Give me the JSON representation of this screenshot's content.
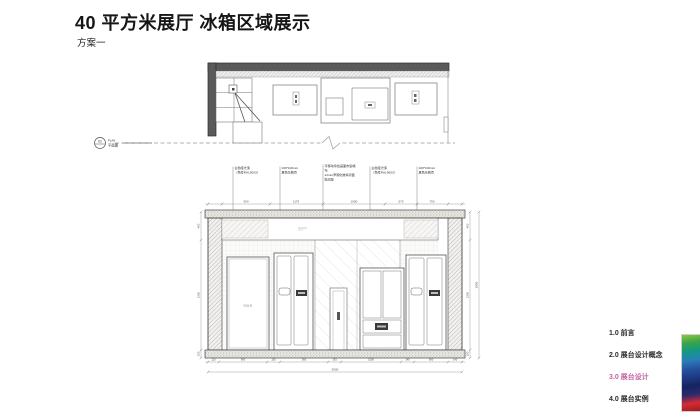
{
  "page": {
    "title": "40 平方米展厅 冰箱区域展示",
    "subtitle": "方案一"
  },
  "plan": {
    "marker_number": "01",
    "marker_name_en": "PLAN",
    "marker_name_cn": "平面图"
  },
  "elevation": {
    "annotations": [
      {
        "l1": "白色哑光漆",
        "l2": "（色号RAL9003）"
      },
      {
        "l1": "100*100mm",
        "l2": "黑色马赛克"
      },
      {
        "l1": "可移动喷绘画面布贴墙",
        "l2": "布",
        "l3": "12mm厚钢化玻璃背面",
        "l4": "贴高膜"
      },
      {
        "l1": "白色哑光漆",
        "l2": "（色号RAL9003）"
      },
      {
        "l1": "100*100mm",
        "l2": "黑色马赛克"
      }
    ],
    "dims_top": [
      "900",
      "1175",
      "1500",
      "575",
      "750"
    ],
    "dims_bottom": [
      "110",
      "900",
      "135",
      "900",
      "135",
      "1500",
      "140",
      "900",
      "140"
    ],
    "dims_left": [
      "400",
      "2300",
      "150"
    ],
    "dims_right": [
      "400",
      "2300",
      "150"
    ],
    "total_width": "5000",
    "total_height": "2850",
    "fridge_label": "SBS"
  },
  "menu": {
    "items": [
      {
        "label": "1.0 前言"
      },
      {
        "label": "2.0 展台设计概念"
      },
      {
        "label": "3.0 展台设计"
      },
      {
        "label": "4.0 展台实例"
      }
    ],
    "active_index": 2,
    "active_color": "#c464a4"
  },
  "stripe": {
    "colors": [
      "#8cc63f",
      "#3aa449",
      "#119a84",
      "#2a7fb8",
      "#27549e",
      "#1d3a85",
      "#16235f",
      "#2d2a6e",
      "#d62b33",
      "#9e1c24"
    ]
  }
}
